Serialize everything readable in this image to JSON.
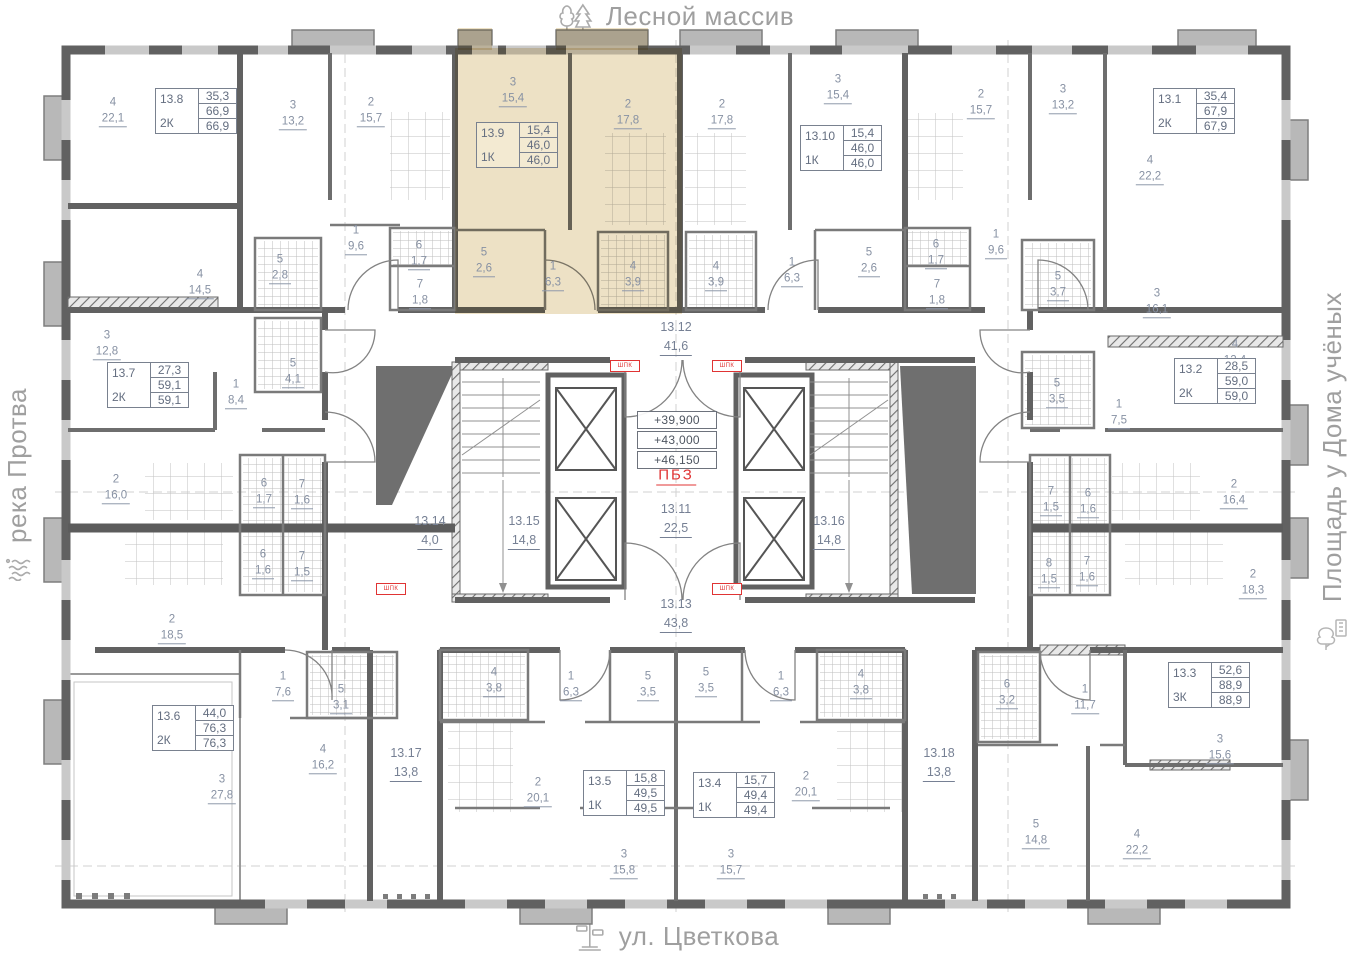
{
  "landmarks": {
    "top": {
      "label": "Лесной массив",
      "icon": "trees-icon"
    },
    "bottom": {
      "label": "ул. Цветкова",
      "icon": "signpost-icon"
    },
    "left": {
      "label": "река Протва",
      "icon": "waves-icon"
    },
    "right": {
      "label": "Площадь у Дома учёных",
      "icon": "park-building-icon"
    }
  },
  "legend": {
    "elevations": [
      "+39,900",
      "+43,000",
      "+46,150"
    ],
    "fire_zone": "ПБЗ",
    "cabinet": "ШПК"
  },
  "colors": {
    "highlight": "#ecdfc0",
    "accent_red": "#e03434",
    "label_gray_blue": "#8791a3",
    "wall_gray": "#616161"
  },
  "apartments": [
    {
      "id": "13.8",
      "type": "2К",
      "a1": "35,3",
      "a2": "66,9",
      "a3": "66,9",
      "x": 155,
      "y": 88
    },
    {
      "id": "13.9",
      "type": "1К",
      "a1": "15,4",
      "a2": "46,0",
      "a3": "46,0",
      "x": 476,
      "y": 122,
      "hl": true
    },
    {
      "id": "13.10",
      "type": "1К",
      "a1": "15,4",
      "a2": "46,0",
      "a3": "46,0",
      "x": 800,
      "y": 125
    },
    {
      "id": "13.1",
      "type": "2К",
      "a1": "35,4",
      "a2": "67,9",
      "a3": "67,9",
      "x": 1153,
      "y": 88
    },
    {
      "id": "13.7",
      "type": "2К",
      "a1": "27,3",
      "a2": "59,1",
      "a3": "59,1",
      "x": 107,
      "y": 362
    },
    {
      "id": "13.2",
      "type": "2К",
      "a1": "28,5",
      "a2": "59,0",
      "a3": "59,0",
      "x": 1174,
      "y": 358
    },
    {
      "id": "13.6",
      "type": "2К",
      "a1": "44,0",
      "a2": "76,3",
      "a3": "76,3",
      "x": 152,
      "y": 705
    },
    {
      "id": "13.5",
      "type": "1К",
      "a1": "15,8",
      "a2": "49,5",
      "a3": "49,5",
      "x": 583,
      "y": 770
    },
    {
      "id": "13.4",
      "type": "1К",
      "a1": "15,7",
      "a2": "49,4",
      "a3": "49,4",
      "x": 693,
      "y": 772
    },
    {
      "id": "13.3",
      "type": "3К",
      "a1": "52,6",
      "a2": "88,9",
      "a3": "88,9",
      "x": 1168,
      "y": 662
    }
  ],
  "corridors": [
    {
      "id": "13.12",
      "a": "41,6",
      "x": 676,
      "y": 338
    },
    {
      "id": "13.11",
      "a": "22,5",
      "x": 676,
      "y": 520
    },
    {
      "id": "13.13",
      "a": "43,8",
      "x": 676,
      "y": 615
    },
    {
      "id": "13.14",
      "a": "4,0",
      "x": 430,
      "y": 532
    },
    {
      "id": "13.15",
      "a": "14,8",
      "x": 524,
      "y": 532
    },
    {
      "id": "13.16",
      "a": "14,8",
      "x": 829,
      "y": 532
    },
    {
      "id": "13.17",
      "a": "13,8",
      "x": 406,
      "y": 764
    },
    {
      "id": "13.18",
      "a": "13,8",
      "x": 939,
      "y": 764
    }
  ],
  "rooms": [
    {
      "n": "4",
      "a": "22,1",
      "x": 113,
      "y": 112
    },
    {
      "n": "3",
      "a": "13,2",
      "x": 293,
      "y": 115
    },
    {
      "n": "2",
      "a": "15,7",
      "x": 371,
      "y": 112
    },
    {
      "n": "3",
      "a": "15,4",
      "x": 513,
      "y": 92,
      "hl": true
    },
    {
      "n": "2",
      "a": "17,8",
      "x": 628,
      "y": 114,
      "hl": true
    },
    {
      "n": "2",
      "a": "17,8",
      "x": 722,
      "y": 114
    },
    {
      "n": "3",
      "a": "15,4",
      "x": 838,
      "y": 89
    },
    {
      "n": "2",
      "a": "15,7",
      "x": 981,
      "y": 104
    },
    {
      "n": "3",
      "a": "13,2",
      "x": 1063,
      "y": 99
    },
    {
      "n": "4",
      "a": "22,2",
      "x": 1150,
      "y": 170
    },
    {
      "n": "4",
      "a": "14,5",
      "x": 200,
      "y": 284
    },
    {
      "n": "5",
      "a": "2,8",
      "x": 280,
      "y": 269
    },
    {
      "n": "1",
      "a": "9,6",
      "x": 356,
      "y": 240
    },
    {
      "n": "6",
      "a": "1,7",
      "x": 419,
      "y": 255
    },
    {
      "n": "7",
      "a": "1,8",
      "x": 420,
      "y": 294
    },
    {
      "n": "5",
      "a": "2,6",
      "x": 484,
      "y": 262,
      "hl": true
    },
    {
      "n": "1",
      "a": "6,3",
      "x": 553,
      "y": 276,
      "hl": true
    },
    {
      "n": "4",
      "a": "3,9",
      "x": 633,
      "y": 276,
      "hl": true
    },
    {
      "n": "4",
      "a": "3,9",
      "x": 716,
      "y": 276
    },
    {
      "n": "1",
      "a": "6,3",
      "x": 792,
      "y": 272
    },
    {
      "n": "5",
      "a": "2,6",
      "x": 869,
      "y": 262
    },
    {
      "n": "6",
      "a": "1,7",
      "x": 936,
      "y": 254
    },
    {
      "n": "7",
      "a": "1,8",
      "x": 937,
      "y": 294
    },
    {
      "n": "1",
      "a": "9,6",
      "x": 996,
      "y": 244
    },
    {
      "n": "5",
      "a": "3,7",
      "x": 1058,
      "y": 286
    },
    {
      "n": "3",
      "a": "16,1",
      "x": 1157,
      "y": 303
    },
    {
      "n": "3",
      "a": "12,8",
      "x": 107,
      "y": 345
    },
    {
      "n": "1",
      "a": "8,4",
      "x": 236,
      "y": 394
    },
    {
      "n": "5",
      "a": "4,1",
      "x": 293,
      "y": 373
    },
    {
      "n": "2",
      "a": "16,0",
      "x": 116,
      "y": 489
    },
    {
      "n": "6",
      "a": "1,7",
      "x": 264,
      "y": 493
    },
    {
      "n": "7",
      "a": "1,6",
      "x": 302,
      "y": 494
    },
    {
      "n": "6",
      "a": "1,6",
      "x": 263,
      "y": 564
    },
    {
      "n": "7",
      "a": "1,5",
      "x": 302,
      "y": 566
    },
    {
      "n": "2",
      "a": "18,5",
      "x": 172,
      "y": 629
    },
    {
      "n": "1",
      "a": "7,6",
      "x": 283,
      "y": 686
    },
    {
      "n": "5",
      "a": "3,1",
      "x": 341,
      "y": 699
    },
    {
      "n": "3",
      "a": "27,8",
      "x": 222,
      "y": 789
    },
    {
      "n": "4",
      "a": "16,2",
      "x": 323,
      "y": 759
    },
    {
      "n": "4",
      "a": "3,8",
      "x": 494,
      "y": 682
    },
    {
      "n": "1",
      "a": "6,3",
      "x": 571,
      "y": 686
    },
    {
      "n": "5",
      "a": "3,5",
      "x": 648,
      "y": 686
    },
    {
      "n": "5",
      "a": "3,5",
      "x": 706,
      "y": 682
    },
    {
      "n": "1",
      "a": "6,3",
      "x": 781,
      "y": 686
    },
    {
      "n": "4",
      "a": "3,8",
      "x": 861,
      "y": 684
    },
    {
      "n": "2",
      "a": "20,1",
      "x": 538,
      "y": 792
    },
    {
      "n": "3",
      "a": "15,8",
      "x": 624,
      "y": 864
    },
    {
      "n": "2",
      "a": "20,1",
      "x": 806,
      "y": 786
    },
    {
      "n": "3",
      "a": "15,7",
      "x": 731,
      "y": 864
    },
    {
      "n": "6",
      "a": "3,2",
      "x": 1007,
      "y": 694
    },
    {
      "n": "1",
      "a": "11,7",
      "x": 1085,
      "y": 699
    },
    {
      "n": "3",
      "a": "15,6",
      "x": 1220,
      "y": 749
    },
    {
      "n": "5",
      "a": "14,8",
      "x": 1036,
      "y": 834
    },
    {
      "n": "4",
      "a": "22,2",
      "x": 1137,
      "y": 844
    },
    {
      "n": "4",
      "a": "12,4",
      "x": 1235,
      "y": 354
    },
    {
      "n": "1",
      "a": "7,5",
      "x": 1119,
      "y": 414
    },
    {
      "n": "5",
      "a": "3,5",
      "x": 1057,
      "y": 393
    },
    {
      "n": "2",
      "a": "16,4",
      "x": 1234,
      "y": 494
    },
    {
      "n": "7",
      "a": "1,5",
      "x": 1051,
      "y": 501
    },
    {
      "n": "6",
      "a": "1,6",
      "x": 1088,
      "y": 503
    },
    {
      "n": "8",
      "a": "1,5",
      "x": 1049,
      "y": 573
    },
    {
      "n": "7",
      "a": "1,6",
      "x": 1087,
      "y": 571
    },
    {
      "n": "2",
      "a": "18,3",
      "x": 1253,
      "y": 584
    }
  ],
  "cabinets": [
    {
      "x": 610,
      "y": 360
    },
    {
      "x": 712,
      "y": 360
    },
    {
      "x": 376,
      "y": 583
    },
    {
      "x": 712,
      "y": 583
    }
  ]
}
